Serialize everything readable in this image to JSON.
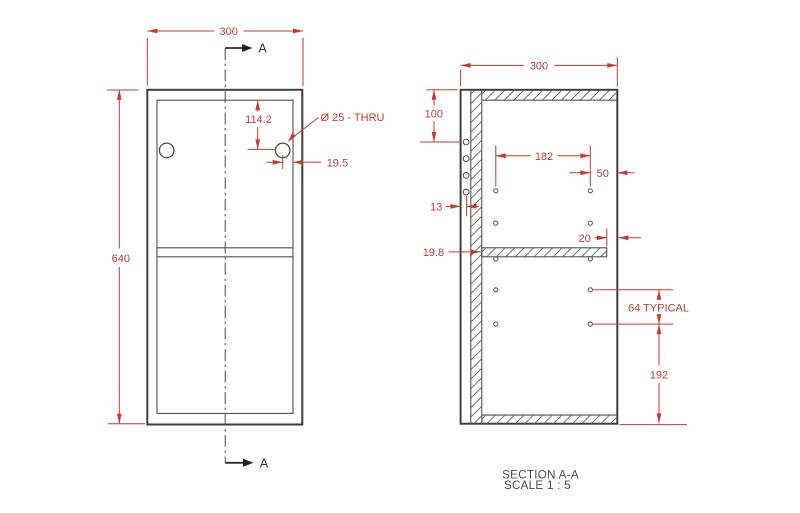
{
  "drawing": {
    "front_view": {
      "width_dim": "300",
      "height_dim": "640",
      "hole_offset_dim": "114.2",
      "hole_callout": "Ø 25 - THRU",
      "hole_edge_dim": "19.5",
      "section_label": "A"
    },
    "section_view": {
      "depth_dim": "300",
      "top_hole_dim": "100",
      "hole_span_dim": "182",
      "front_hole_dim": "50",
      "back_hole_dim": "13",
      "shelf_thickness_dim": "19.8",
      "shelf_setback_dim": "20",
      "hole_pitch_dim": "64 TYPICAL",
      "bottom_span_dim": "192",
      "caption_title": "SECTION A-A",
      "caption_scale": "SCALE 1 : 5"
    },
    "colors": {
      "dimension_red": "#c63a32",
      "line_dark": "#3f3f3f",
      "caption_gray": "#4a4a4a",
      "background": "#ffffff"
    }
  }
}
